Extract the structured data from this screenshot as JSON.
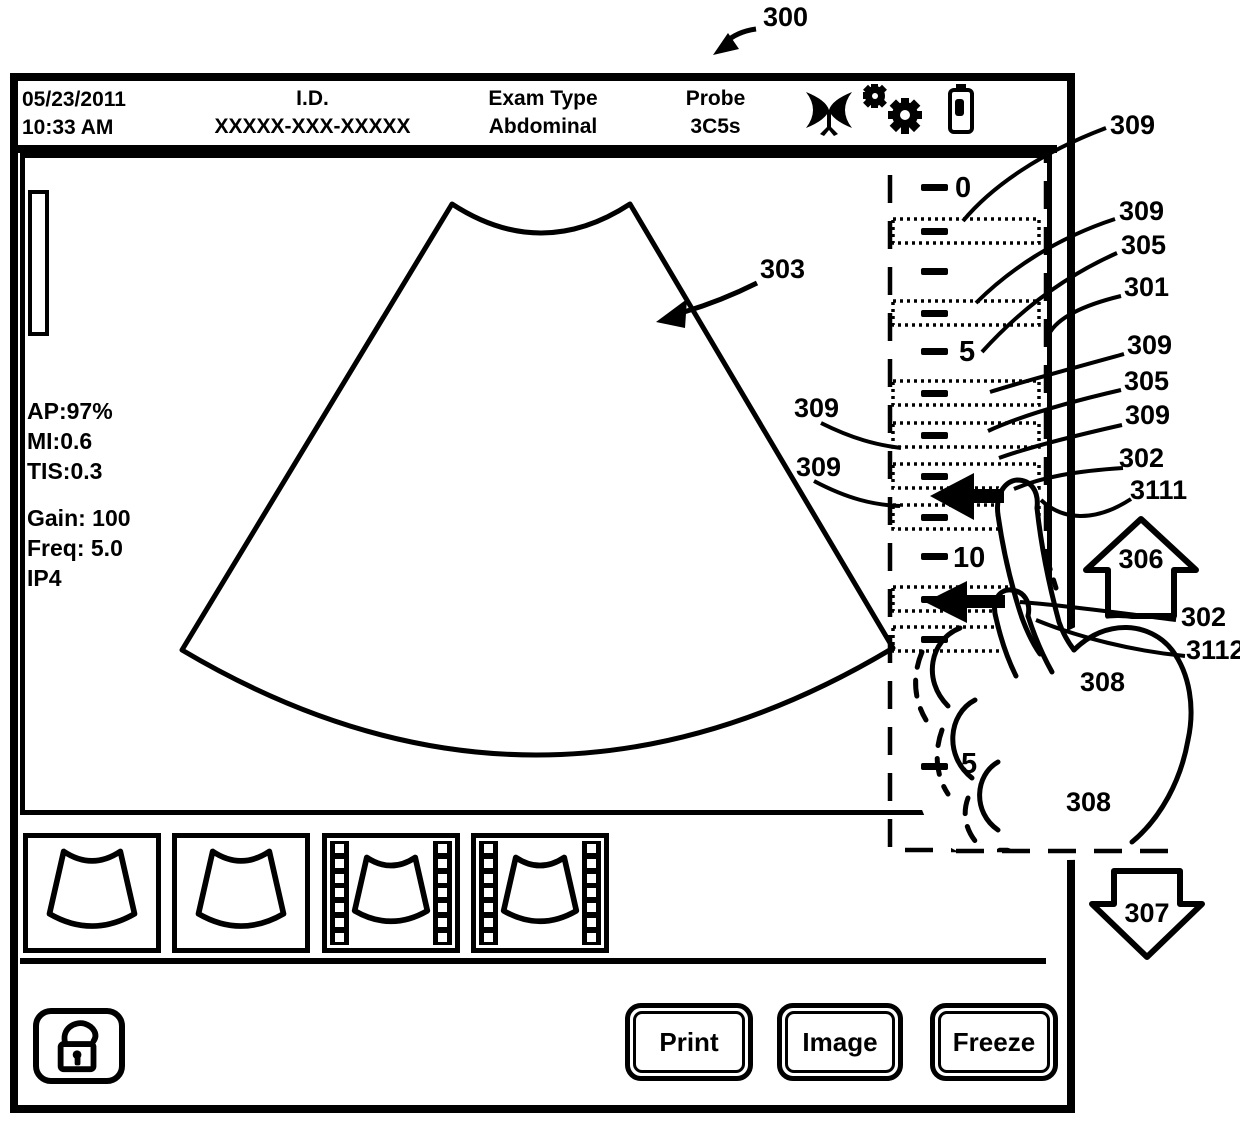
{
  "refs": {
    "r300": "300",
    "r301": "301",
    "r302": "302",
    "r303": "303",
    "r305": "305",
    "r306": "306",
    "r307": "307",
    "r308": "308",
    "r309": "309",
    "r3111": "3111",
    "r3112": "3112"
  },
  "header": {
    "date": "05/23/2011",
    "time": "10:33 AM",
    "id_label": "I.D.",
    "id_value": "XXXXX-XXX-XXXXX",
    "exam_label": "Exam Type",
    "exam_value": "Abdominal",
    "probe_label": "Probe",
    "probe_value": "3C5s"
  },
  "display": {
    "ap": "AP:97%",
    "mi": "MI:0.6",
    "tis": "TIS:0.3",
    "gain": "Gain: 100",
    "freq": "Freq: 5.0",
    "ip": "IP4"
  },
  "scale": {
    "t0": "0",
    "t5": "5",
    "t10": "10",
    "t15": "5"
  },
  "buttons": {
    "print": "Print",
    "image": "Image",
    "freeze": "Freeze"
  }
}
